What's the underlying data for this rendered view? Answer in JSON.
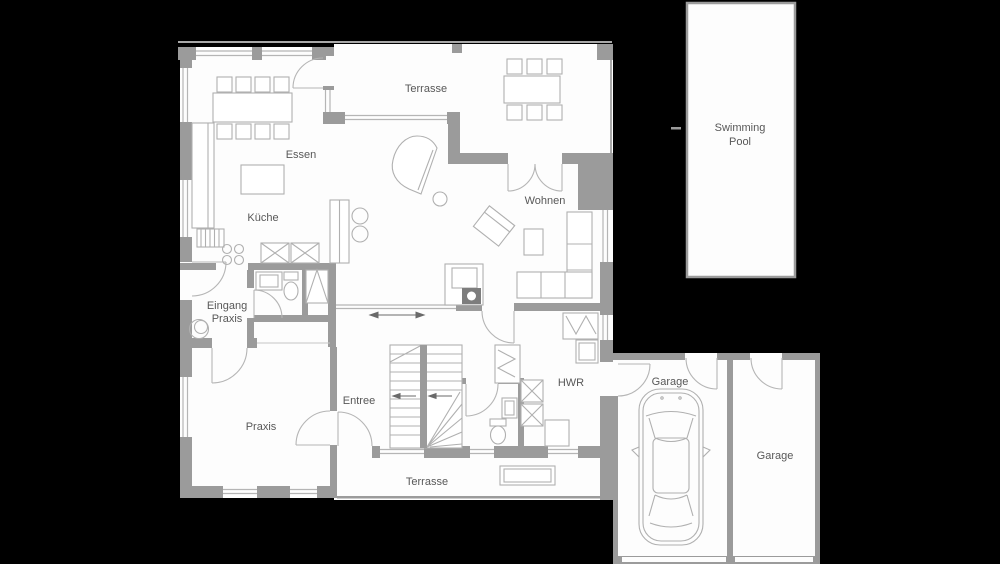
{
  "title": "Ground floor plan (Erdgeschoss Grundriss)",
  "colors": {
    "background": "#000000",
    "floor": "#fdfdfd",
    "wall": "#9b9b9b",
    "window_line": "#b5b5b5",
    "furniture_stroke": "#b0b0b0",
    "label_text": "#585858",
    "stove": "#7d7d7d"
  },
  "rooms": {
    "terrasse_top": {
      "label": "Terrasse"
    },
    "essen": {
      "label": "Essen"
    },
    "kueche": {
      "label": "Küche"
    },
    "wohnen": {
      "label": "Wohnen"
    },
    "eingang_praxis": {
      "label": "Eingang Praxis",
      "line1": "Eingang",
      "line2": "Praxis"
    },
    "praxis": {
      "label": "Praxis"
    },
    "entree": {
      "label": "Entree"
    },
    "hwr": {
      "label": "HWR"
    },
    "terrasse_bottom": {
      "label": "Terrasse"
    },
    "garage_left": {
      "label": "Garage"
    },
    "garage_right": {
      "label": "Garage"
    },
    "swimming_pool": {
      "label": "Swimming Pool",
      "line1": "Swimming",
      "line2": "Pool"
    }
  }
}
